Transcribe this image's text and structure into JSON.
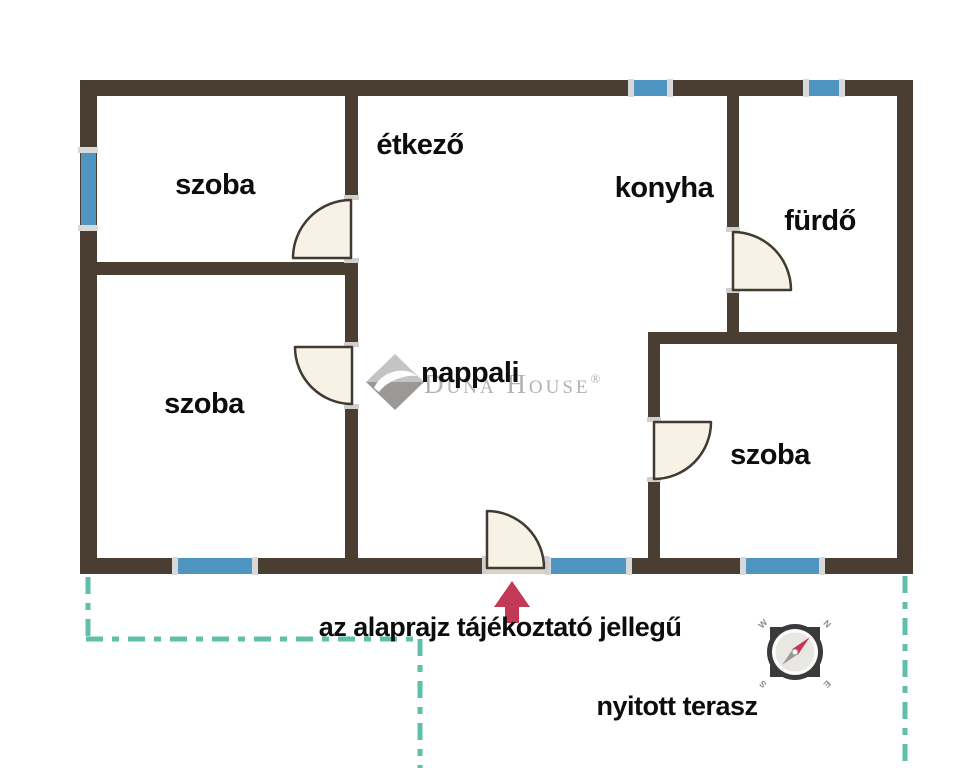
{
  "floor_plan": {
    "rooms": {
      "room_top_left": "szoba",
      "dining": "étkező",
      "kitchen": "konyha",
      "bathroom": "fürdő",
      "living": "nappali",
      "room_bottom_left": "szoba",
      "room_right": "szoba"
    },
    "annotations": {
      "disclaimer": "az alaprajz tájékoztató jellegű",
      "terrace": "nyitott terasz"
    },
    "watermark": {
      "d": "D",
      "una": "UNA",
      "h": " H",
      "ouse": "OUSE",
      "registered": "®"
    },
    "compass": {
      "n": "N",
      "s": "S",
      "e": "E",
      "w": "W"
    },
    "colors": {
      "wall": "#4a3e33",
      "window": "#4e95c1",
      "window_cap": "#d9d9d9",
      "door_fill": "#f8f2e6",
      "door_stroke": "#403a33",
      "entrance_sill": "#dcd4c6",
      "terrace_dash": "#5fbfa8",
      "arrow": "#c23a56",
      "watermark_gray": "#b3b1b1"
    }
  }
}
